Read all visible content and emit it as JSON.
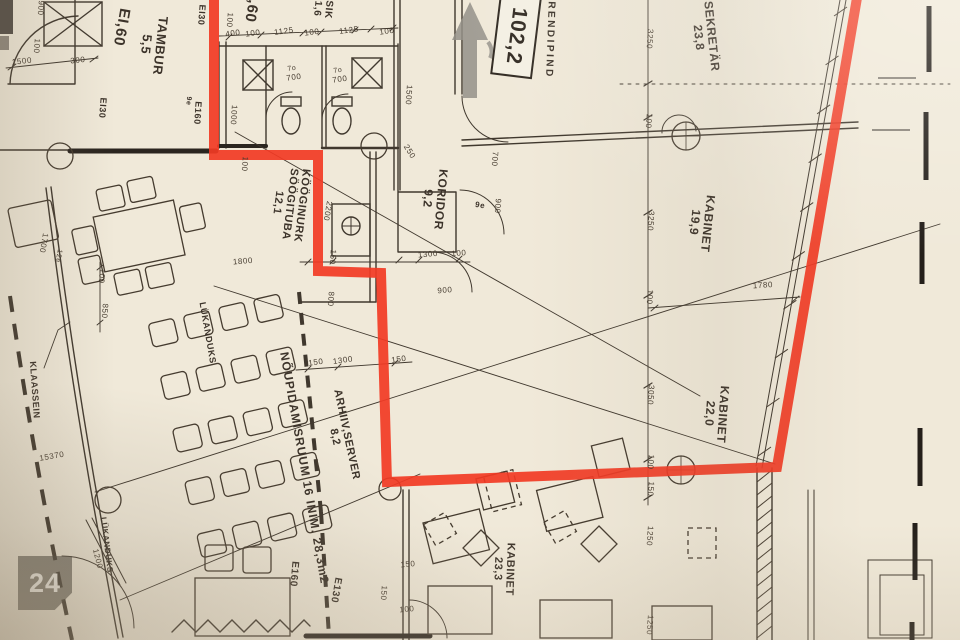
{
  "colors": {
    "highlight": "#f23a24",
    "ink": "#43392d",
    "dark_ink": "#2b251f",
    "paper": "#f0e9d9",
    "arrow_gray": "rgba(148,144,136,0.85)",
    "badge_bg": "rgba(72,67,60,0.62)"
  },
  "badge": {
    "count": "24"
  },
  "area_box": {
    "value": "102,2"
  },
  "room_labels": [
    {
      "lines": [
        "TAMBUR",
        "5,5"
      ],
      "x": 153,
      "y": 45,
      "rot": 96,
      "size": 13
    },
    {
      "lines": [
        "SIK",
        "1,6"
      ],
      "x": 322,
      "y": 9,
      "rot": 95,
      "size": 10
    },
    {
      "lines": [
        "KÖÖGINURK",
        "SÖÖGITUBA",
        "12,1"
      ],
      "x": 289,
      "y": 204,
      "rot": 97,
      "size": 11
    },
    {
      "lines": [
        "KORIDOR",
        "9,2"
      ],
      "x": 434,
      "y": 199,
      "rot": 95,
      "size": 12
    },
    {
      "lines": [
        "SEKRETÄR",
        "23,8"
      ],
      "x": 705,
      "y": 37,
      "rot": 84,
      "size": 12
    },
    {
      "lines": [
        "KABINET",
        "19,9"
      ],
      "x": 701,
      "y": 223,
      "rot": 96,
      "size": 12
    },
    {
      "lines": [
        "KABINET",
        "22,0"
      ],
      "x": 716,
      "y": 414,
      "rot": 94,
      "size": 12
    },
    {
      "lines": [
        "KABINET",
        "23,3"
      ],
      "x": 503,
      "y": 569,
      "rot": 92,
      "size": 11
    },
    {
      "lines": [
        "ARHIIV,SERVER",
        "8,2"
      ],
      "x": 340,
      "y": 436,
      "rot": 78,
      "size": 11
    },
    {
      "lines": [
        "NÕUPIDAMISRUUM 16 INIM. 28,3m2"
      ],
      "x": 304,
      "y": 468,
      "rot": 80,
      "size": 12,
      "spacing": 1
    },
    {
      "lines": [
        "RENDIPIND"
      ],
      "x": 549,
      "y": 40,
      "rot": 92,
      "size": 10,
      "spacing": 2.5
    },
    {
      "lines": [
        "KLAASSEIN"
      ],
      "x": 34,
      "y": 390,
      "rot": 86,
      "size": 9
    },
    {
      "lines": [
        "LÜKANDUKS"
      ],
      "x": 207,
      "y": 333,
      "rot": 80,
      "size": 9
    },
    {
      "lines": [
        "LÜKANDUKS"
      ],
      "x": 106,
      "y": 545,
      "rot": 83,
      "size": 8
    }
  ],
  "fire_labels": [
    {
      "text": "EI,60",
      "x": 121,
      "y": 27,
      "rot": 100,
      "size": 15
    },
    {
      "text": ",60",
      "x": 251,
      "y": 11,
      "rot": 100,
      "size": 15
    },
    {
      "text": "EI30",
      "x": 201,
      "y": 15,
      "rot": 94,
      "size": 9
    },
    {
      "text": "EI30",
      "x": 102,
      "y": 108,
      "rot": 94,
      "size": 9
    },
    {
      "text": "E160",
      "x": 197,
      "y": 113,
      "rot": 94,
      "size": 9
    },
    {
      "text": "9e",
      "x": 188,
      "y": 101,
      "rot": 94,
      "size": 7
    },
    {
      "text": "E160",
      "x": 293,
      "y": 574,
      "rot": 95,
      "size": 10
    },
    {
      "text": "E130",
      "x": 335,
      "y": 590,
      "rot": 100,
      "size": 10
    },
    {
      "text": "9e",
      "x": 480,
      "y": 206,
      "rot": 10,
      "size": 8
    }
  ],
  "dim_labels": [
    {
      "text": "900",
      "x": 40,
      "y": 8,
      "rot": 94
    },
    {
      "text": "100",
      "x": 36,
      "y": 46,
      "rot": 94
    },
    {
      "text": "1500",
      "x": 22,
      "y": 62,
      "rot": -6
    },
    {
      "text": "300",
      "x": 78,
      "y": 61,
      "rot": -6
    },
    {
      "text": "100",
      "x": 229,
      "y": 20,
      "rot": 94
    },
    {
      "text": "400",
      "x": 233,
      "y": 34,
      "rot": -8
    },
    {
      "text": "100",
      "x": 253,
      "y": 34,
      "rot": -8
    },
    {
      "text": "1125",
      "x": 284,
      "y": 32,
      "rot": -8
    },
    {
      "text": "100",
      "x": 312,
      "y": 33,
      "rot": -8
    },
    {
      "text": "1125",
      "x": 349,
      "y": 31,
      "rot": -8
    },
    {
      "text": "100",
      "x": 387,
      "y": 32,
      "rot": -8
    },
    {
      "text": "7o",
      "x": 292,
      "y": 69,
      "rot": -8,
      "size": 7
    },
    {
      "text": "700",
      "x": 294,
      "y": 78,
      "rot": -8
    },
    {
      "text": "7o",
      "x": 338,
      "y": 71,
      "rot": -8,
      "size": 7
    },
    {
      "text": "700",
      "x": 340,
      "y": 80,
      "rot": -8
    },
    {
      "text": "1000",
      "x": 233,
      "y": 115,
      "rot": 94
    },
    {
      "text": "1500",
      "x": 408,
      "y": 95,
      "rot": 94
    },
    {
      "text": "250",
      "x": 409,
      "y": 152,
      "rot": 58
    },
    {
      "text": "700",
      "x": 494,
      "y": 159,
      "rot": 94
    },
    {
      "text": "900",
      "x": 497,
      "y": 206,
      "rot": 94
    },
    {
      "text": "1300",
      "x": 428,
      "y": 255,
      "rot": -5
    },
    {
      "text": "100",
      "x": 459,
      "y": 254,
      "rot": -5
    },
    {
      "text": "900",
      "x": 445,
      "y": 291,
      "rot": -5
    },
    {
      "text": "3250",
      "x": 649,
      "y": 39,
      "rot": 94
    },
    {
      "text": "100",
      "x": 648,
      "y": 121,
      "rot": 94
    },
    {
      "text": "3250",
      "x": 650,
      "y": 221,
      "rot": 94
    },
    {
      "text": "100",
      "x": 649,
      "y": 297,
      "rot": 94
    },
    {
      "text": "1780",
      "x": 763,
      "y": 286,
      "rot": -4
    },
    {
      "text": "3050",
      "x": 650,
      "y": 395,
      "rot": 94
    },
    {
      "text": "100",
      "x": 650,
      "y": 462,
      "rot": 94
    },
    {
      "text": "150",
      "x": 650,
      "y": 489,
      "rot": 94
    },
    {
      "text": "100",
      "x": 244,
      "y": 164,
      "rot": 94
    },
    {
      "text": "2200",
      "x": 327,
      "y": 211,
      "rot": 100
    },
    {
      "text": "150",
      "x": 332,
      "y": 257,
      "rot": 94
    },
    {
      "text": "1800",
      "x": 243,
      "y": 262,
      "rot": -5
    },
    {
      "text": "800",
      "x": 330,
      "y": 299,
      "rot": 94
    },
    {
      "text": "150",
      "x": 316,
      "y": 363,
      "rot": -8
    },
    {
      "text": "1300",
      "x": 343,
      "y": 361,
      "rot": -8
    },
    {
      "text": "150",
      "x": 399,
      "y": 360,
      "rot": -8
    },
    {
      "text": "850",
      "x": 104,
      "y": 311,
      "rot": 94
    },
    {
      "text": "100",
      "x": 101,
      "y": 276,
      "rot": 94
    },
    {
      "text": "15370",
      "x": 52,
      "y": 457,
      "rot": -10
    },
    {
      "text": "1700",
      "x": 43,
      "y": 243,
      "rot": 100
    },
    {
      "text": "12e",
      "x": 58,
      "y": 256,
      "rot": 100,
      "size": 7
    },
    {
      "text": "150",
      "x": 408,
      "y": 565,
      "rot": -5
    },
    {
      "text": "150",
      "x": 383,
      "y": 593,
      "rot": 94
    },
    {
      "text": "100",
      "x": 407,
      "y": 610,
      "rot": -5
    },
    {
      "text": "1250",
      "x": 649,
      "y": 536,
      "rot": 94
    },
    {
      "text": "1250",
      "x": 649,
      "y": 625,
      "rot": 94
    },
    {
      "text": "1200",
      "x": 97,
      "y": 559,
      "rot": 76
    }
  ]
}
